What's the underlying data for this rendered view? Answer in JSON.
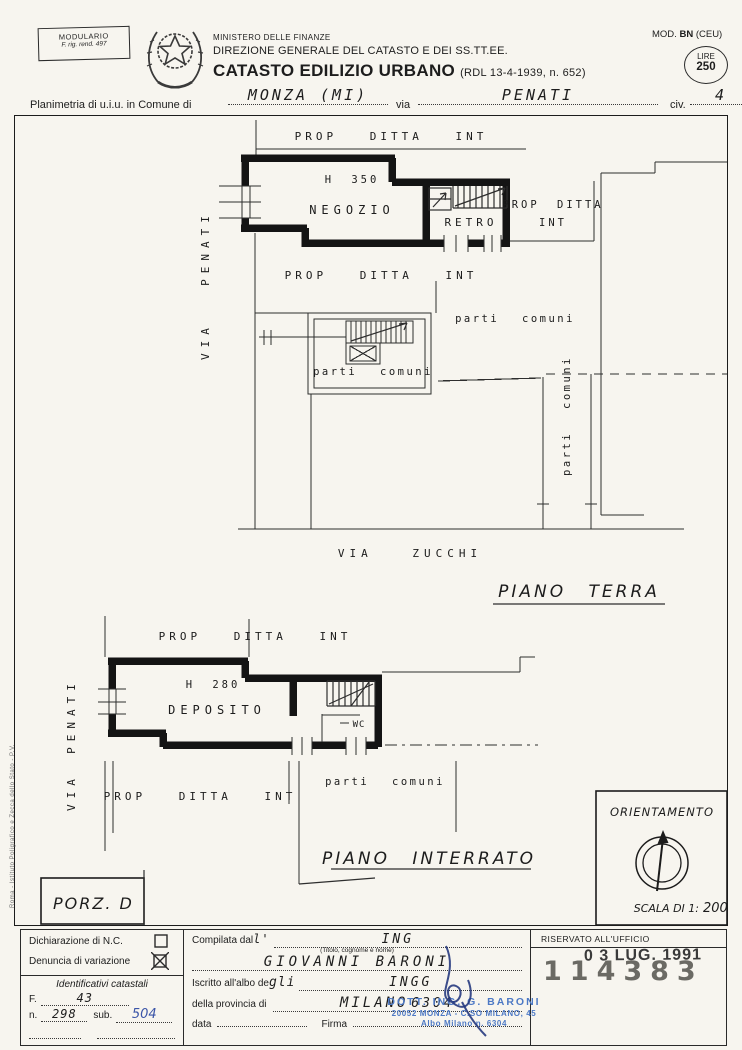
{
  "header": {
    "modulario_1": "MODULARIO",
    "modulario_2": "F. rig. rend. 497",
    "ministry": "MINISTERO DELLE FINANZE",
    "direction": "DIREZIONE GENERALE DEL CATASTO E DEI SS.TT.EE.",
    "title": "CATASTO EDILIZIO URBANO",
    "title_ref": "(RDL 13-4-1939, n. 652)",
    "mod_prefix": "MOD.",
    "mod_bold": "BN",
    "mod_suffix": "(CEU)",
    "lire_label": "LIRE",
    "lire_value": "250",
    "planimetria_label": "Planimetria di u.i.u. in Comune di",
    "comune_value": "MONZA (MI)",
    "via_label": "via",
    "via_value": "PENATI",
    "civ_label": "civ.",
    "civ_value": "4"
  },
  "terra": {
    "prop_top": "PROP DITTA INT",
    "height": "H 350",
    "room": "NEGOZIO",
    "retro": "RETRO",
    "prop_right_1": "PROP DITTA",
    "prop_right_2": "INT",
    "prop_below": "PROP DITTA INT",
    "common_stair": "parti comuni",
    "common_main": "parti comuni",
    "common_corridor": "parti comuni",
    "street_left_1": "VIA",
    "street_left_2": "PENATI",
    "street_bottom": "VIA ZUCCHI",
    "title": "PIANO TERRA"
  },
  "interrato": {
    "prop_top": "PROP DITTA INT",
    "height": "H 280",
    "room": "DEPOSITO",
    "wc": "WC",
    "common": "parti comuni",
    "prop_below": "PROP DITTA INT",
    "street_1": "VIA",
    "street_2": "PENATI",
    "title": "PIANO INTERRATO"
  },
  "porzione": "PORZ. D",
  "orientamento": {
    "label": "ORIENTAMENTO",
    "scala_label": "SCALA DI 1:",
    "scala_value": "200"
  },
  "footer": {
    "decl_label": "Dichiarazione di N.C.",
    "var_label": "Denuncia di variazione",
    "ident_label": "Identificativi catastali",
    "f_label": "F.",
    "f_value": "43",
    "n_label": "n.",
    "n_value": "298",
    "sub_label": "sub.",
    "sub_value": "504",
    "compilata_label": "Compilata dal",
    "compilata_apos": "l'",
    "compilata_value": "ING",
    "titolo_note": "(Titolo, cognome e nome)",
    "nome_value": "GIOVANNI  BARONI",
    "iscritto_label": "Iscritto all'albo de",
    "iscritto_hw": "gli",
    "albo_value": "INGG",
    "provincia_label": "della provincia di",
    "provincia_value": "MILANO",
    "provincia_num": "6304",
    "data_label": "data",
    "firma_label": "Firma",
    "riservato_label": "RISERVATO ALL'UFFICIO",
    "date_stamp": "0 3 LUG. 1991",
    "serial_stamp": "114383",
    "blue_stamp_1": "DOTT. ING. G. BARONI",
    "blue_stamp_2": "20052 MONZA - C.SO MILANO, 45",
    "blue_stamp_3": "Albo Milano n. 6304"
  },
  "side_note": "Roma - Istituto Poligrafico e Zecca dello Stato - P.V."
}
